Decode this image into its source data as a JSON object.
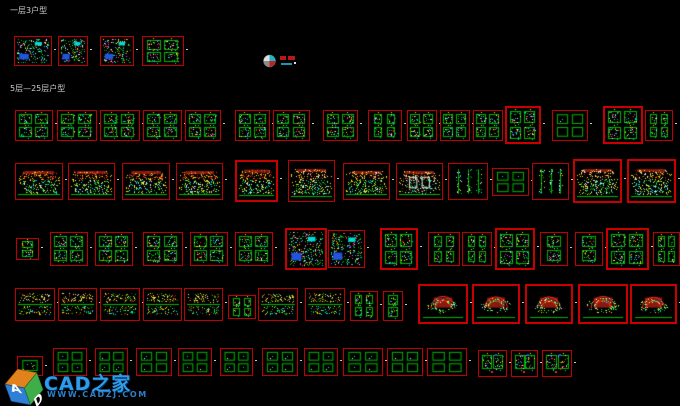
{
  "page": {
    "width": 680,
    "height": 406,
    "background": "#000000"
  },
  "section_labels": [
    {
      "text": "一层3户型"
    },
    {
      "text": "5层—25层户型"
    }
  ],
  "north_symbol": {
    "icon": "north-arrow-icon",
    "red_mark": "red-annotation",
    "cyan_mark": "cyan-annotation"
  },
  "watermark": {
    "brand": "CAD之家",
    "url": "WWW.CADZJ.COM",
    "logo_letters": [
      "A",
      "D"
    ],
    "brand_color": "#2e9ce8",
    "url_color": "#2d7fc8"
  },
  "palette": {
    "frame_red": "#c00000",
    "green": "#00b400",
    "brightgreen": "#30ff50",
    "cyan": "#00dcdc",
    "yellow": "#ffe000",
    "white": "#e8e8e8",
    "red": "#ff2828",
    "darkred": "#8a1a10",
    "magenta": "#dd44dd",
    "blue": "#2255dd",
    "orange": "#cc7722"
  },
  "sheet_rows": [
    {
      "y": 36,
      "h": 30,
      "frames": [
        {
          "x": 14,
          "w": 38,
          "kind": "plan_dense"
        },
        {
          "x": 58,
          "w": 30,
          "kind": "plan_dense"
        },
        {
          "x": 100,
          "w": 34,
          "kind": "plan_dense"
        },
        {
          "x": 142,
          "w": 42,
          "kind": "plan4"
        }
      ]
    },
    {
      "y": 110,
      "h": 31,
      "frames": [
        {
          "x": 15,
          "w": 38,
          "kind": "plan4"
        },
        {
          "x": 57,
          "w": 40,
          "kind": "plan4"
        },
        {
          "x": 100,
          "w": 40,
          "kind": "plan4"
        },
        {
          "x": 143,
          "w": 39,
          "kind": "plan4"
        },
        {
          "x": 185,
          "w": 36,
          "kind": "plan4"
        },
        {
          "x": 235,
          "w": 35,
          "kind": "plan4"
        },
        {
          "x": 273,
          "w": 37,
          "kind": "plan4"
        },
        {
          "x": 323,
          "w": 35,
          "kind": "plan4"
        },
        {
          "x": 368,
          "w": 34,
          "kind": "plan2"
        },
        {
          "x": 407,
          "w": 30,
          "kind": "plan4"
        },
        {
          "x": 440,
          "w": 30,
          "kind": "plan4"
        },
        {
          "x": 473,
          "w": 30,
          "kind": "plan4"
        },
        {
          "x": 505,
          "w": 36,
          "y": 106,
          "h": 38,
          "b": 2,
          "kind": "plan4"
        },
        {
          "x": 552,
          "w": 36,
          "kind": "detail"
        },
        {
          "x": 603,
          "w": 40,
          "y": 106,
          "h": 38,
          "b": 2,
          "kind": "plan4"
        },
        {
          "x": 645,
          "w": 28,
          "kind": "plan2"
        }
      ]
    },
    {
      "y": 163,
      "h": 37,
      "frames": [
        {
          "x": 15,
          "w": 48,
          "kind": "elev"
        },
        {
          "x": 68,
          "w": 47,
          "kind": "elev"
        },
        {
          "x": 122,
          "w": 48,
          "kind": "elev"
        },
        {
          "x": 176,
          "w": 47,
          "kind": "elev"
        },
        {
          "x": 235,
          "w": 43,
          "y": 160,
          "h": 42,
          "b": 2,
          "kind": "elev"
        },
        {
          "x": 288,
          "w": 47,
          "y": 160,
          "h": 42,
          "kind": "elev_y"
        },
        {
          "x": 343,
          "w": 47,
          "kind": "elev_y"
        },
        {
          "x": 396,
          "w": 47,
          "kind": "elev_w"
        },
        {
          "x": 448,
          "w": 40,
          "kind": "section"
        },
        {
          "x": 492,
          "w": 37,
          "y": 168,
          "h": 28,
          "kind": "detail"
        },
        {
          "x": 532,
          "w": 37,
          "kind": "section"
        },
        {
          "x": 573,
          "w": 49,
          "y": 159,
          "h": 44,
          "b": 2,
          "kind": "elev_y"
        },
        {
          "x": 627,
          "w": 49,
          "y": 159,
          "h": 44,
          "b": 2,
          "kind": "elev_y"
        }
      ]
    },
    {
      "y": 232,
      "h": 34,
      "frames": [
        {
          "x": 16,
          "w": 23,
          "y": 238,
          "h": 22,
          "kind": "plan1"
        },
        {
          "x": 50,
          "w": 38,
          "kind": "plan4"
        },
        {
          "x": 95,
          "w": 38,
          "kind": "plan4"
        },
        {
          "x": 143,
          "w": 40,
          "kind": "plan4"
        },
        {
          "x": 190,
          "w": 38,
          "kind": "plan4"
        },
        {
          "x": 235,
          "w": 38,
          "kind": "plan4"
        },
        {
          "x": 285,
          "w": 42,
          "y": 228,
          "h": 42,
          "b": 2,
          "kind": "plan_dense"
        },
        {
          "x": 328,
          "w": 37,
          "y": 230,
          "h": 38,
          "kind": "plan_dense"
        },
        {
          "x": 380,
          "w": 38,
          "y": 228,
          "h": 42,
          "b": 2,
          "kind": "plan4"
        },
        {
          "x": 428,
          "w": 32,
          "kind": "plan2"
        },
        {
          "x": 462,
          "w": 30,
          "kind": "plan2"
        },
        {
          "x": 495,
          "w": 40,
          "y": 228,
          "h": 42,
          "b": 2,
          "kind": "plan4"
        },
        {
          "x": 540,
          "w": 28,
          "kind": "plan1"
        },
        {
          "x": 575,
          "w": 28,
          "kind": "plan1"
        },
        {
          "x": 606,
          "w": 43,
          "y": 228,
          "h": 42,
          "b": 2,
          "kind": "plan4"
        },
        {
          "x": 653,
          "w": 27,
          "kind": "plan2"
        }
      ]
    },
    {
      "y": 288,
      "h": 33,
      "frames": [
        {
          "x": 15,
          "w": 40,
          "kind": "mixed"
        },
        {
          "x": 58,
          "w": 39,
          "kind": "mixed"
        },
        {
          "x": 100,
          "w": 40,
          "kind": "mixed"
        },
        {
          "x": 143,
          "w": 39,
          "kind": "mixed"
        },
        {
          "x": 184,
          "w": 39,
          "kind": "mixed"
        },
        {
          "x": 228,
          "w": 28,
          "y": 295,
          "h": 24,
          "kind": "plan2"
        },
        {
          "x": 258,
          "w": 40,
          "kind": "mixed"
        },
        {
          "x": 305,
          "w": 40,
          "kind": "mixed"
        },
        {
          "x": 350,
          "w": 28,
          "y": 291,
          "h": 30,
          "kind": "plan2"
        },
        {
          "x": 383,
          "w": 20,
          "y": 291,
          "h": 30,
          "kind": "plan1"
        },
        {
          "x": 418,
          "w": 50,
          "y": 284,
          "h": 40,
          "b": 2,
          "kind": "roof"
        },
        {
          "x": 472,
          "w": 48,
          "y": 284,
          "h": 40,
          "b": 2,
          "kind": "roof"
        },
        {
          "x": 525,
          "w": 48,
          "y": 284,
          "h": 40,
          "b": 2,
          "kind": "roof"
        },
        {
          "x": 578,
          "w": 50,
          "y": 284,
          "h": 40,
          "b": 2,
          "kind": "roof"
        },
        {
          "x": 630,
          "w": 47,
          "y": 284,
          "h": 40,
          "b": 2,
          "kind": "roof"
        }
      ]
    },
    {
      "y": 348,
      "h": 28,
      "frames": [
        {
          "x": 17,
          "w": 26,
          "y": 356,
          "h": 20,
          "kind": "detail1"
        },
        {
          "x": 53,
          "w": 34,
          "kind": "detail"
        },
        {
          "x": 95,
          "w": 33,
          "kind": "detail"
        },
        {
          "x": 136,
          "w": 36,
          "kind": "detail"
        },
        {
          "x": 178,
          "w": 34,
          "kind": "detail"
        },
        {
          "x": 220,
          "w": 33,
          "kind": "detail"
        },
        {
          "x": 262,
          "w": 36,
          "kind": "detail"
        },
        {
          "x": 304,
          "w": 34,
          "kind": "detail"
        },
        {
          "x": 343,
          "w": 40,
          "kind": "detail"
        },
        {
          "x": 387,
          "w": 36,
          "kind": "detail"
        },
        {
          "x": 427,
          "w": 40,
          "kind": "detail"
        },
        {
          "x": 478,
          "w": 29,
          "y": 350,
          "h": 27,
          "kind": "plan2v"
        },
        {
          "x": 511,
          "w": 27,
          "y": 350,
          "h": 27,
          "kind": "plan2v"
        },
        {
          "x": 542,
          "w": 30,
          "y": 350,
          "h": 27,
          "kind": "plan2v"
        }
      ]
    }
  ]
}
